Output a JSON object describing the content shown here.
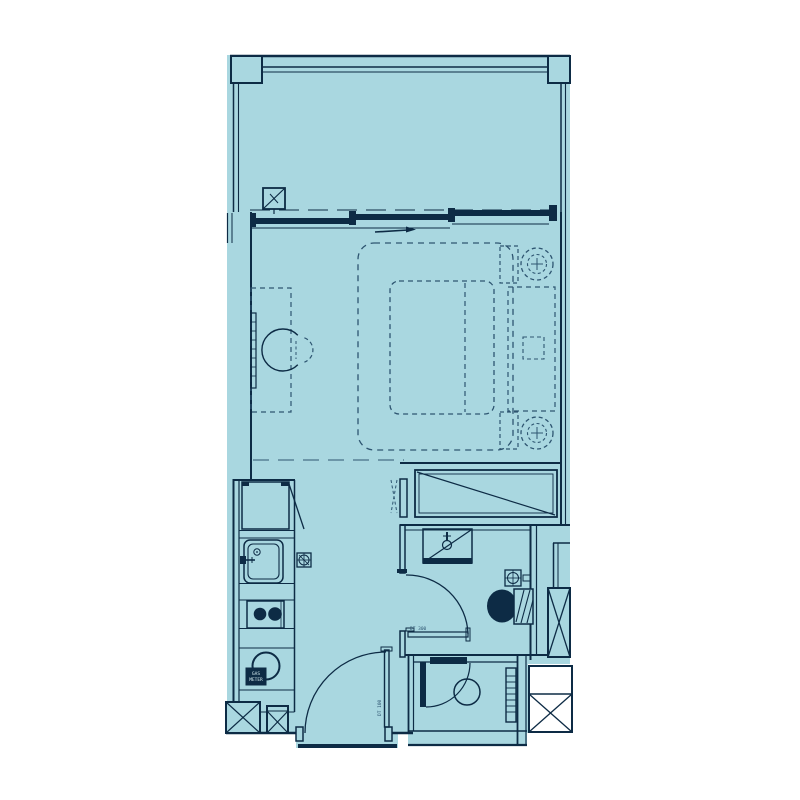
{
  "meta": {
    "title": "Studio apartment floor plan",
    "drawing_type": "architectural-floor-plan"
  },
  "colors": {
    "floor": "#a9d7e0",
    "line": "#0d2b45",
    "dash": "#2e5571",
    "paper": "#ffffff"
  },
  "annotations": {
    "gas_meter_line1": "GAS",
    "gas_meter_line2": "METER",
    "bathroom_level_tag": "DT 300",
    "entry_door_tag": "DT 100"
  },
  "rooms": [
    {
      "name": "balcony"
    },
    {
      "name": "bedroom"
    },
    {
      "name": "kitchen"
    },
    {
      "name": "bathroom"
    },
    {
      "name": "utility-room"
    },
    {
      "name": "entry"
    }
  ],
  "fixtures": [
    "balcony-floor-drain",
    "sliding-door",
    "desk",
    "desk-chair",
    "wall-tv",
    "area-rug",
    "double-bed",
    "headboard-bench",
    "nightstand",
    "bedside-lamp",
    "fridge",
    "kitchen-sink",
    "cooktop",
    "gas-meter",
    "floor-drain",
    "wardrobe",
    "vanity-basin",
    "toilet",
    "bathroom-door",
    "entry-door",
    "utility-door",
    "washer",
    "shelving-unit",
    "service-shaft",
    "corner-shaft"
  ]
}
